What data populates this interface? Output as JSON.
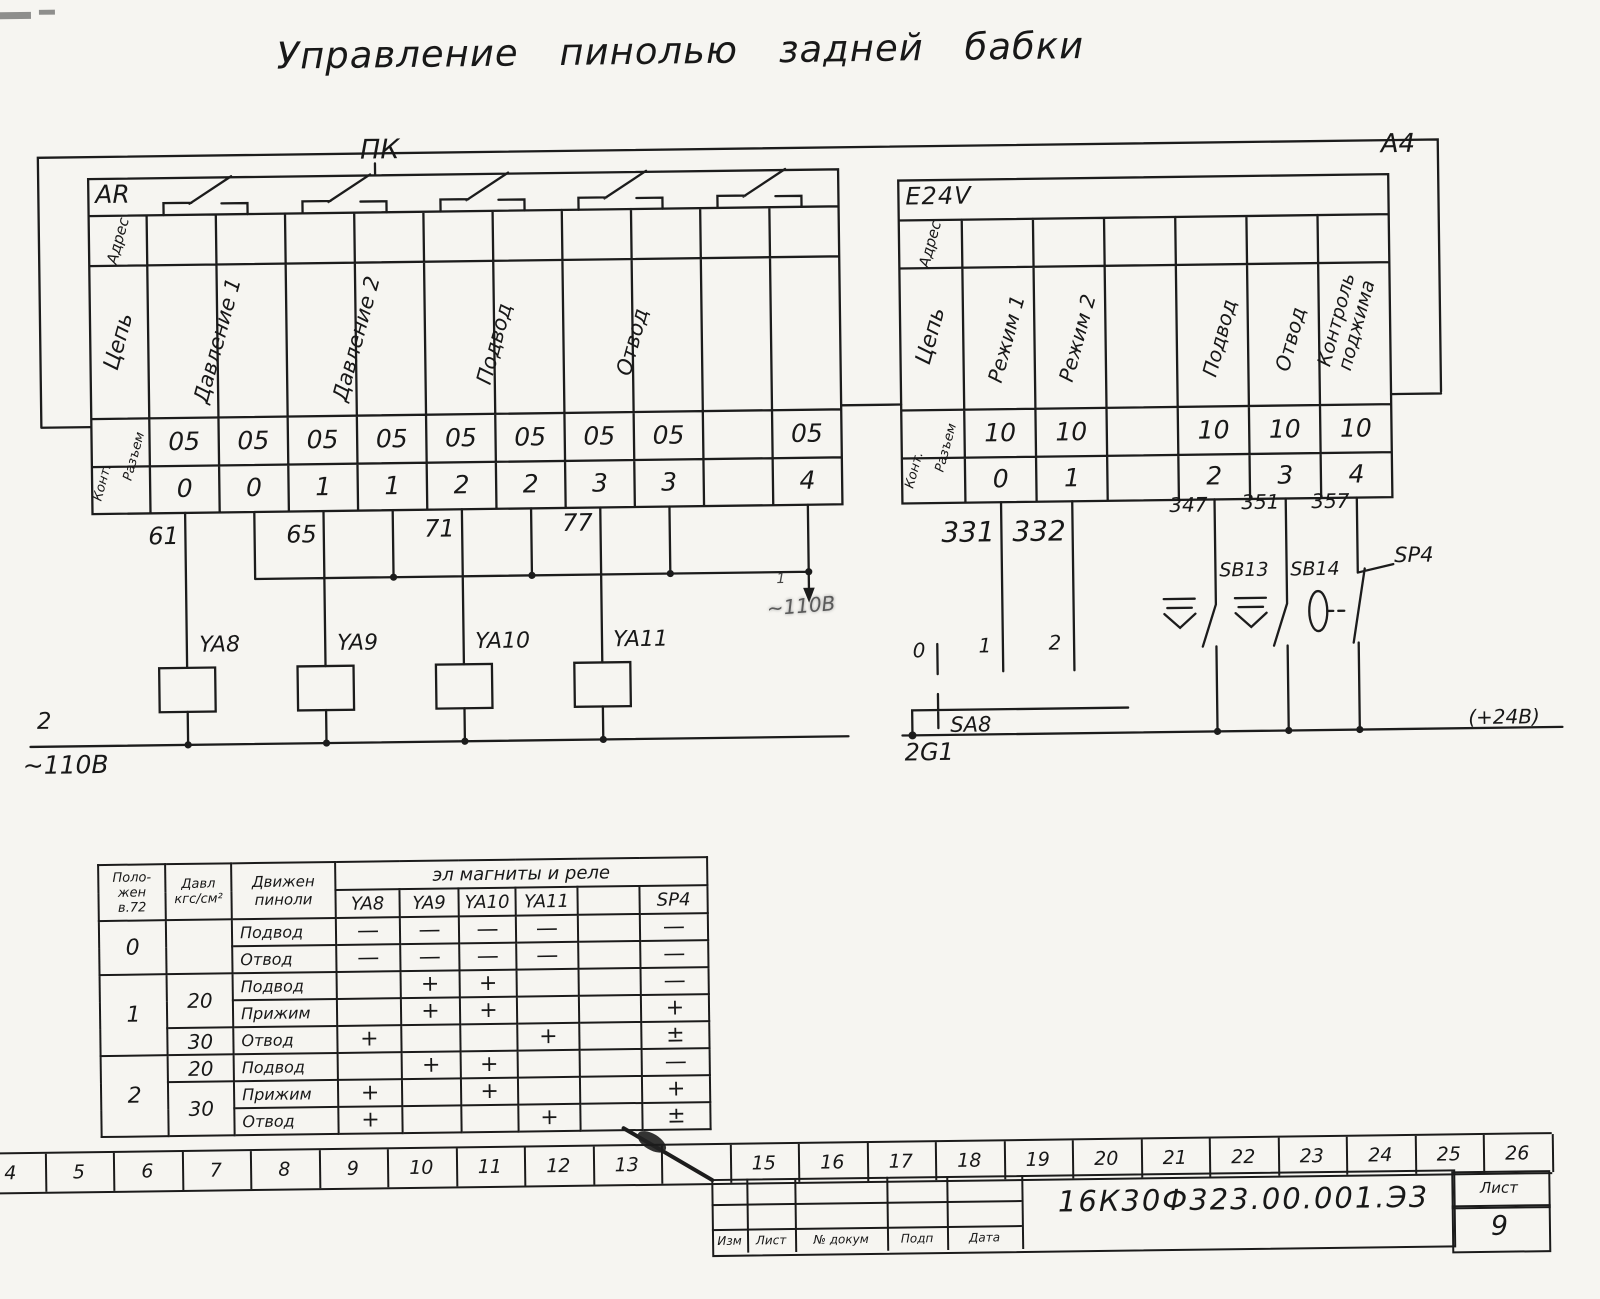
{
  "title": "Управление  пинолью  задней  бабки",
  "frame": {
    "sheet_format": "A4",
    "pk_label": "ПК"
  },
  "left_block": {
    "name": "AR",
    "row_labels": {
      "address": "Адрес",
      "circuit": "Цепь",
      "connector": "Разъем",
      "contact": "Конт."
    },
    "circuits": [
      "Давление 1",
      "Давление 2",
      "Подвод",
      "Отвод"
    ],
    "connector_row": [
      "05",
      "05",
      "05",
      "05",
      "05",
      "05",
      "05",
      "05",
      "",
      "05"
    ],
    "contact_row": [
      "0",
      "0",
      "1",
      "1",
      "2",
      "2",
      "3",
      "3",
      "",
      "4"
    ],
    "wire_numbers": [
      "61",
      "65",
      "71",
      "77"
    ],
    "solenoids": [
      "YA8",
      "YA9",
      "YA10",
      "YA11"
    ],
    "bus_bottom": {
      "wire": "2",
      "voltage": "~110В"
    },
    "bus_mid": {
      "wire": "1",
      "voltage": "~110В"
    }
  },
  "right_block": {
    "name": "E24V",
    "row_labels": {
      "address": "Адрес",
      "circuit": "Цепь",
      "connector": "Разъем",
      "contact": "Конт."
    },
    "circuits": [
      "Режим 1",
      "Режим 2",
      "Подвод",
      "Отвод",
      "Контроль\nподжима"
    ],
    "connector_row": [
      "10",
      "10",
      "",
      "10",
      "10",
      "10"
    ],
    "contact_row": [
      "0",
      "1",
      "",
      "2",
      "3",
      "4"
    ],
    "wire_numbers": [
      "331",
      "332",
      "347",
      "351",
      "357"
    ],
    "selector": {
      "name": "SA8",
      "positions": [
        "0",
        "1",
        "2"
      ]
    },
    "buttons": [
      "SB13",
      "SB14"
    ],
    "pressure_switch": "SP4",
    "bus": {
      "left_label": "2G1",
      "right_label": "(+24В)"
    }
  },
  "logic_table": {
    "headers": {
      "position": "Поло-\nжен\nв.72",
      "pressure": "Давл\nкгс/см²",
      "movement": "Движен\nпиноли",
      "group": "эл  магниты   и  реле",
      "devices": [
        "YA8",
        "YA9",
        "YA10",
        "YA11",
        "",
        "SP4"
      ]
    },
    "rows": [
      {
        "pos": "0",
        "press": "",
        "move": "Подвод",
        "cells": [
          "—",
          "—",
          "—",
          "—",
          "",
          "—"
        ]
      },
      {
        "move": "Отвод",
        "cells": [
          "—",
          "—",
          "—",
          "—",
          "",
          "—"
        ]
      },
      {
        "pos": "1",
        "press": "20",
        "move": "Подвод",
        "cells": [
          "",
          "+",
          "+",
          "",
          "",
          "—"
        ]
      },
      {
        "move": "Прижим",
        "cells": [
          "",
          "+",
          "+",
          "",
          "",
          "+"
        ]
      },
      {
        "press": "30",
        "move": "Отвод",
        "cells": [
          "+",
          "",
          "",
          "+",
          "",
          "±"
        ]
      },
      {
        "pos": "2",
        "press": "20",
        "move": "Подвод",
        "cells": [
          "",
          "+",
          "+",
          "",
          "",
          "—"
        ]
      },
      {
        "press": "30",
        "move": "Прижим",
        "cells": [
          "+",
          "",
          "+",
          "",
          "",
          "+"
        ]
      },
      {
        "move": "Отвод",
        "cells": [
          "+",
          "",
          "",
          "+",
          "",
          "±"
        ]
      }
    ]
  },
  "ruler": {
    "numbers": [
      "4",
      "5",
      "6",
      "7",
      "8",
      "9",
      "10",
      "11",
      "12",
      "13",
      "",
      "15",
      "16",
      "17",
      "18",
      "19",
      "20",
      "21",
      "22",
      "23",
      "24",
      "25",
      "26"
    ]
  },
  "title_block": {
    "document_number": "16К30Ф323.00.001.Э3",
    "sheet_label": "Лист",
    "sheet_number": "9",
    "footer_labels": [
      "Изм",
      "Лист",
      "№ докум",
      "Подп",
      "Дата"
    ]
  }
}
